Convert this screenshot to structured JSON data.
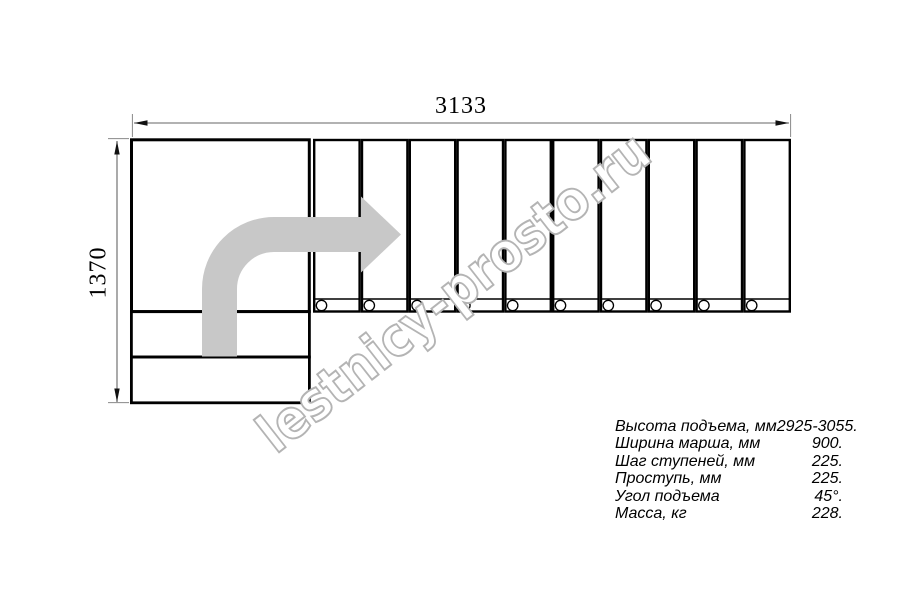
{
  "drawing": {
    "dim_width_label": "3133",
    "dim_height_label": "1370",
    "tread_count": 10,
    "colors": {
      "outline": "#000000",
      "dimension": "#666666",
      "arrow_fill": "#c8c8c8",
      "watermark": "#b4b4b4"
    }
  },
  "watermark": {
    "text": "lestnicy-prosto.ru"
  },
  "specs": {
    "rows": [
      {
        "label": "Высота подъема, мм",
        "value": "2925-3055."
      },
      {
        "label": "Ширина марша, мм",
        "value": "900."
      },
      {
        "label": "Шаг ступеней, мм",
        "value": "225."
      },
      {
        "label": "Проступь, мм",
        "value": "225."
      },
      {
        "label": "Угол подъема",
        "value": "45°."
      },
      {
        "label": "Масса, кг",
        "value": "228."
      }
    ]
  }
}
